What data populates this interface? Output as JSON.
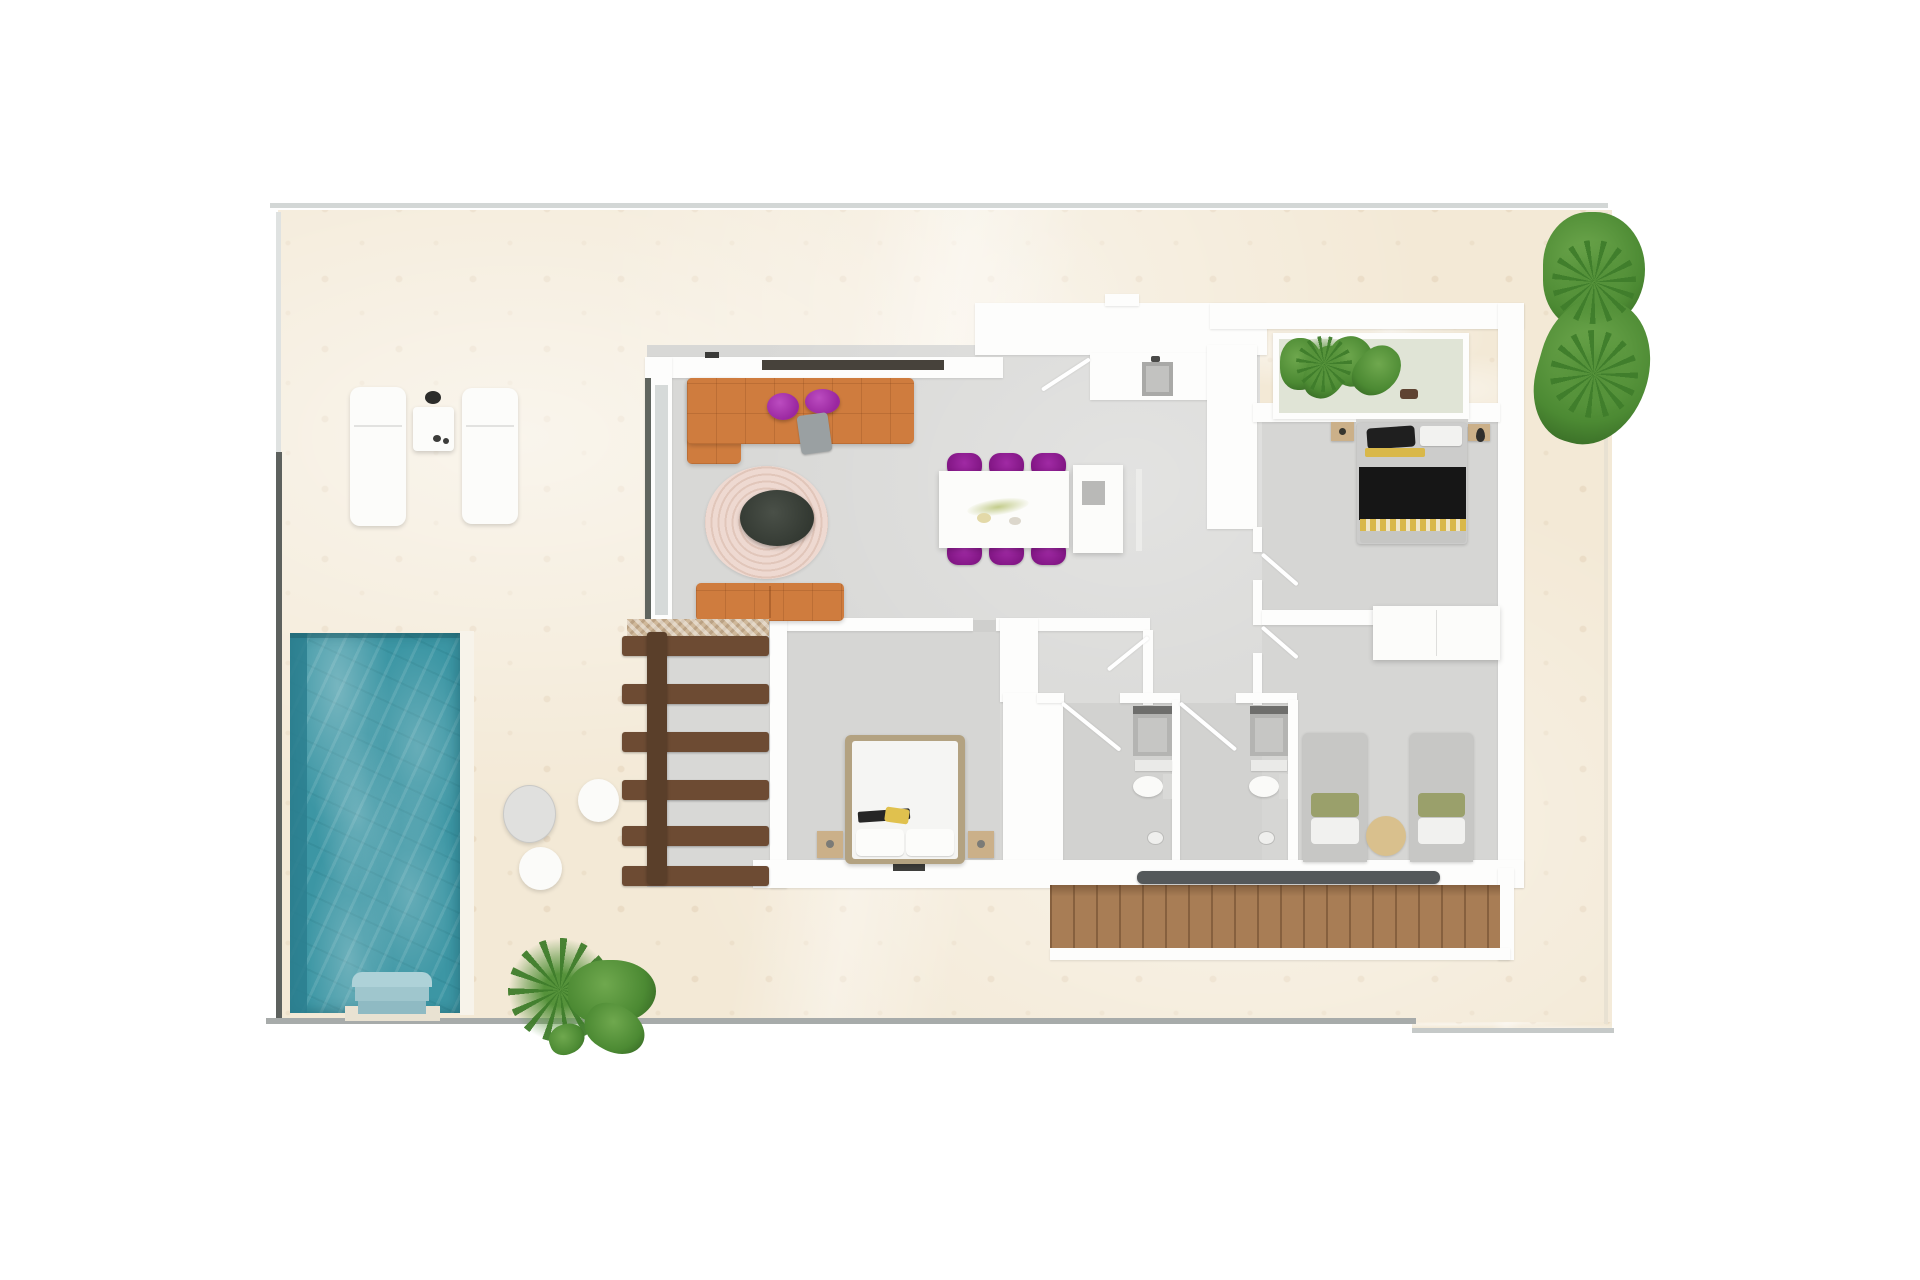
{
  "scene": {
    "kind": "architectural-floor-plan-3d-render",
    "view": "top-down",
    "visible_text": "none"
  },
  "palette": {
    "background": "#ffffff",
    "terrace_tile": "#f3e9d6",
    "interior_floor": "#d8d8d6",
    "bathroom_floor": "#d2d2d0",
    "wall_white": "#fdfdfc",
    "pool_water": "#3c96a4",
    "pool_edge_dark": "#2b7f8f",
    "pool_steps": "#9fc6cd",
    "sofa_orange": "#cf7c3e",
    "pouf_purple": "#a833ab",
    "dining_chair_purple": "#8a1b8d",
    "rug_pink": "#ecd8d0",
    "coffee_table_dark": "#3a4039",
    "pergola_wood": "#6d4b33",
    "stairs_wood": "#a87d55",
    "handrail_grey": "#54585a",
    "plant_green": "#4c8a33",
    "bed_frame_tan": "#b3a281",
    "blanket_black": "#161616",
    "accent_yellow": "#d9b84a",
    "twin_bed_grey": "#c7c7c5",
    "nightstand_tan": "#cbb089",
    "fence_dark": "#5d615e"
  },
  "rooms": [
    {
      "id": "terrace",
      "name": "outdoor terrace with tiled deck"
    },
    {
      "id": "pool",
      "name": "swimming pool with steps"
    },
    {
      "id": "living-room",
      "name": "living room with L-shaped sofa and round rug"
    },
    {
      "id": "dining-area",
      "name": "dining area with table and six chairs"
    },
    {
      "id": "kitchen",
      "name": "kitchen with counter, sink and island"
    },
    {
      "id": "master-bedroom",
      "name": "double bedroom with tan framed bed"
    },
    {
      "id": "bedroom-double",
      "name": "bedroom with black and yellow double bed"
    },
    {
      "id": "bedroom-twin",
      "name": "bedroom with two single beds"
    },
    {
      "id": "bathroom-1",
      "name": "bathroom with shower and toilet"
    },
    {
      "id": "bathroom-2",
      "name": "bathroom with shower and toilet"
    },
    {
      "id": "pergola",
      "name": "pergola with wooden slats"
    },
    {
      "id": "hallway",
      "name": "hallway with interior doors"
    }
  ],
  "objects": [
    {
      "id": "sun-loungers",
      "count": 2
    },
    {
      "id": "lounger-side-table",
      "count": 1
    },
    {
      "id": "round-patio-tables",
      "count": 3
    },
    {
      "id": "planter-box-with-plants",
      "count": 1
    },
    {
      "id": "corner-tree",
      "count": 1
    },
    {
      "id": "ground-plants",
      "count": 3
    },
    {
      "id": "exterior-staircase",
      "steps": "wood, with grey handrail"
    },
    {
      "id": "door-swings",
      "count": 6
    }
  ]
}
